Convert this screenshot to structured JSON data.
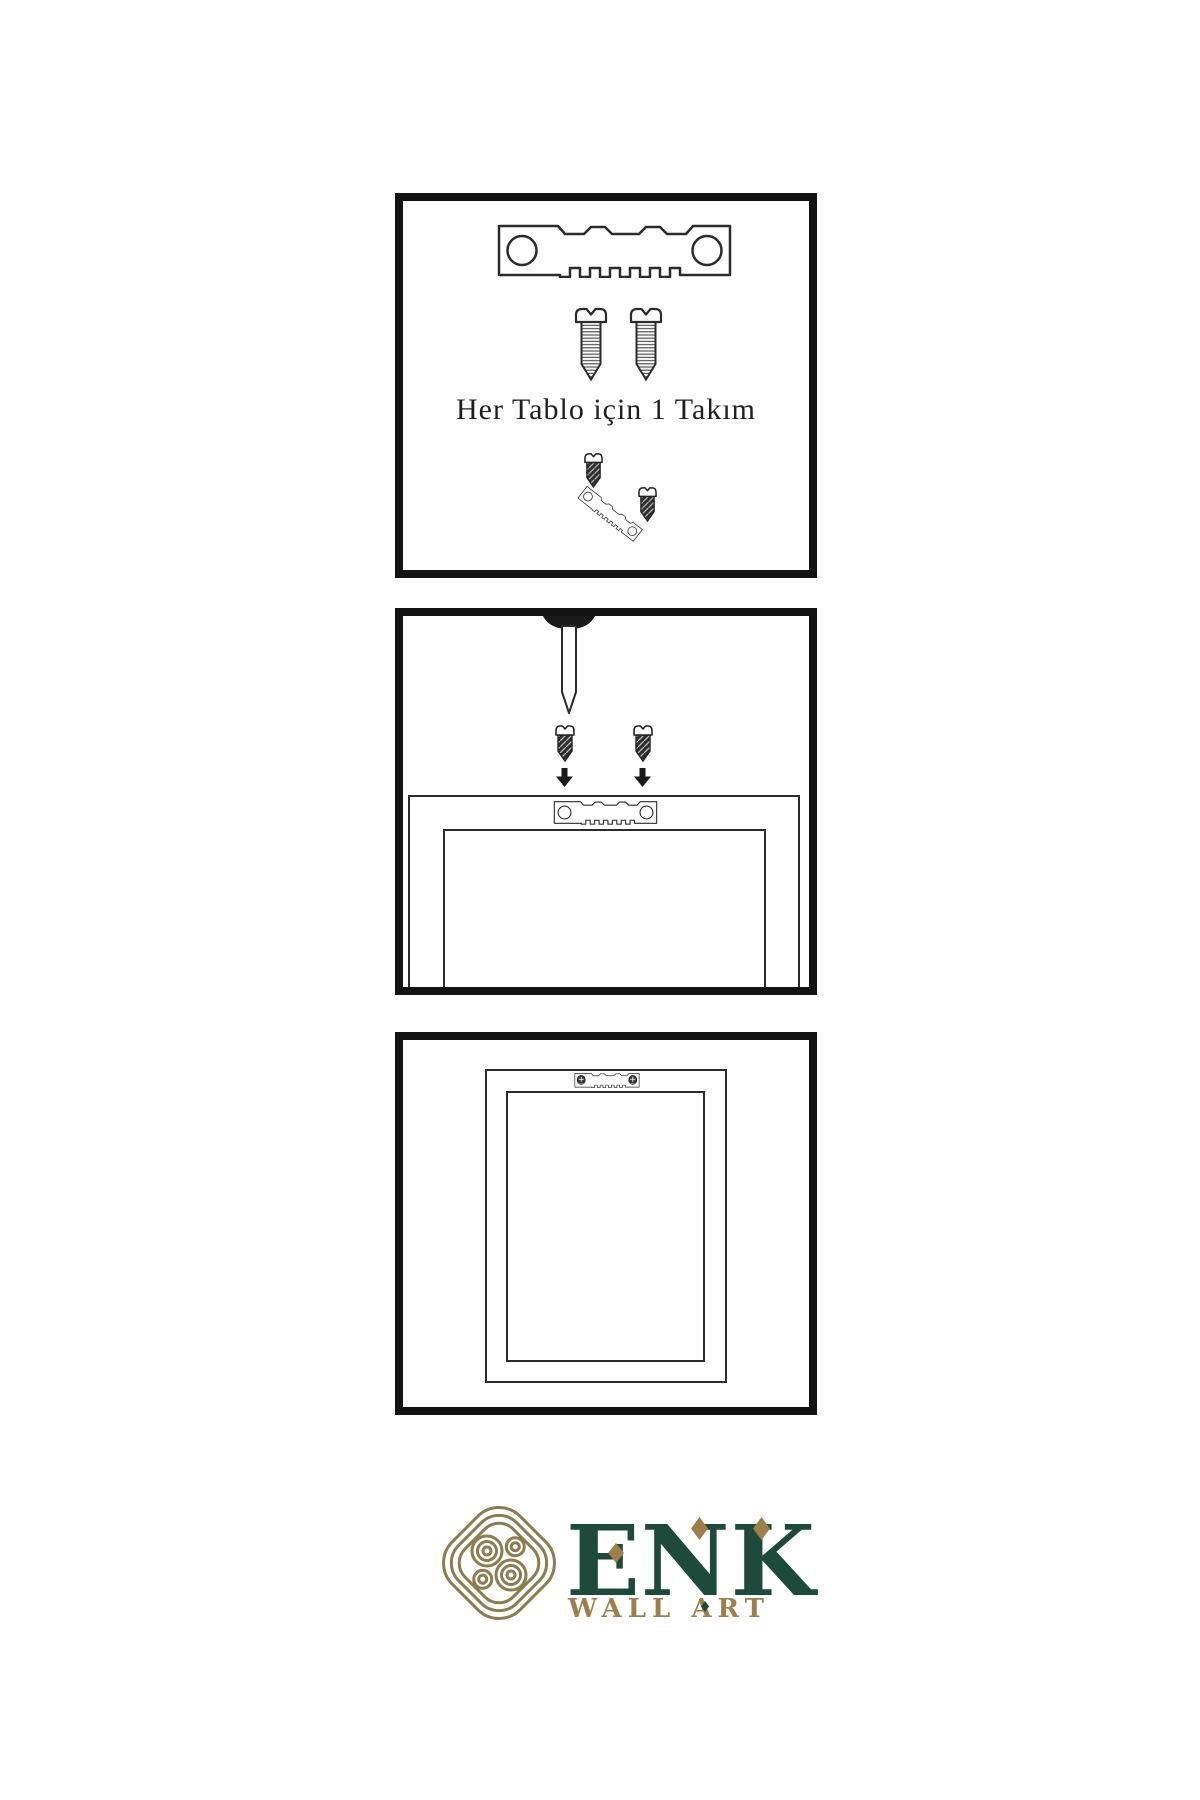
{
  "page": {
    "background": "#ffffff",
    "line_color": "#2b2b2b",
    "panel_border_color": "#131313"
  },
  "steps": [
    {
      "caption": "Her Tablo için 1 Takım",
      "items": [
        "sawtooth-hanger",
        "screw",
        "screw",
        "mini-screw",
        "angled-sawtooth-hanger",
        "mini-screw"
      ]
    },
    {
      "caption": "",
      "items": [
        "wall-nail",
        "dark-screw",
        "dark-screw",
        "down-arrow",
        "down-arrow",
        "frame-back",
        "sawtooth-hanger"
      ]
    },
    {
      "caption": "",
      "items": [
        "frame-back",
        "mounted-sawtooth-hanger-with-screws"
      ]
    }
  ],
  "brand": {
    "name": "ENK",
    "tagline": "WALL ART",
    "colors": {
      "green": "#1d4a3a",
      "gold": "#9d8049",
      "knot_gold": "#8c7c4e"
    }
  }
}
